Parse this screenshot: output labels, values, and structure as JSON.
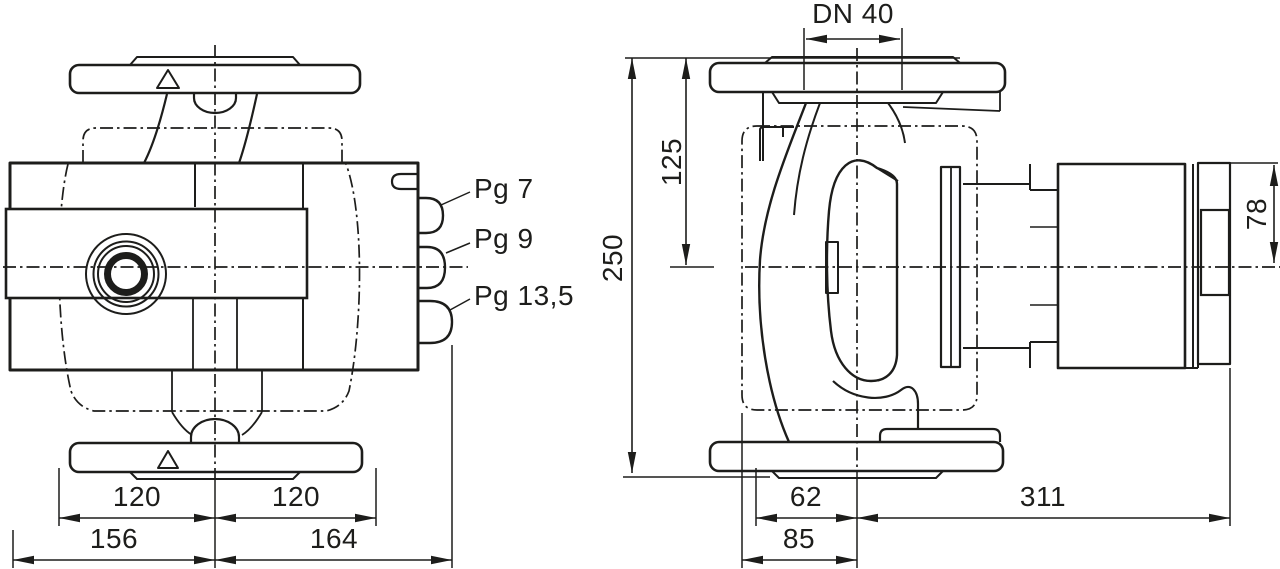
{
  "drawing": {
    "background": "#ffffff",
    "line_color": "#1d1d1b",
    "front": {
      "glands": {
        "g1": "Pg 7",
        "g2": "Pg 9",
        "g3": "Pg 13,5"
      },
      "dims": {
        "pitch_left": "120",
        "pitch_right": "120",
        "overall_left": "156",
        "overall_right": "164"
      }
    },
    "side": {
      "dims": {
        "dn": "DN 40",
        "top_to_axis": "125",
        "height": "250",
        "axis_to_motor_top": "78",
        "axis_front": "62",
        "foot": "85",
        "axis_back": "311"
      }
    }
  }
}
